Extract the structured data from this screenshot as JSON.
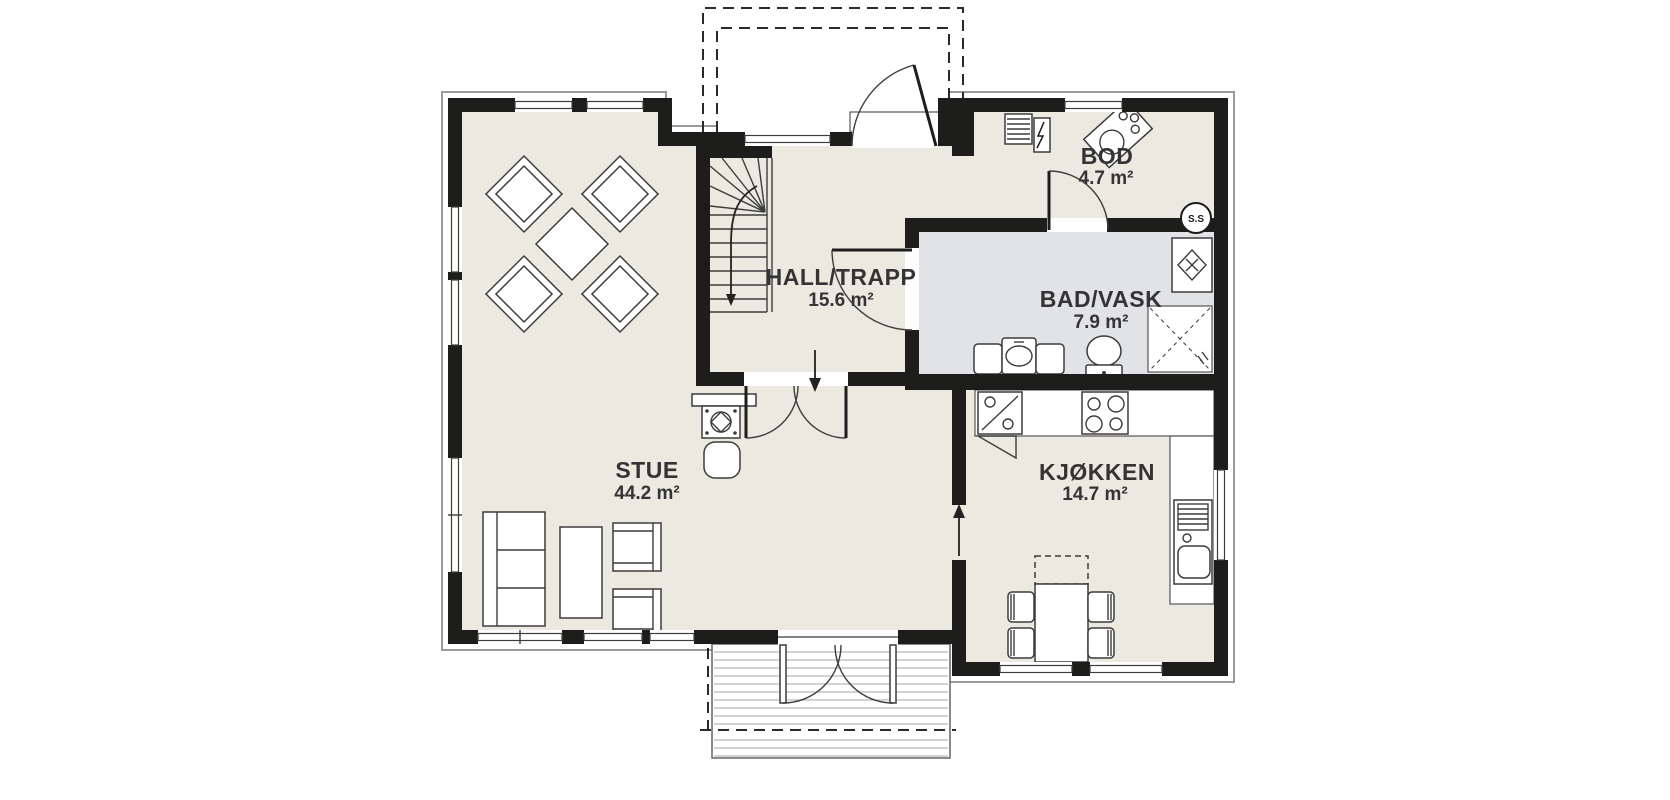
{
  "plan": {
    "rooms": [
      {
        "name": "STUE",
        "area": "44.2 m²"
      },
      {
        "name": "HALL/TRAPP",
        "area": "15.6 m²"
      },
      {
        "name": "BOD",
        "area": "4.7 m²"
      },
      {
        "name": "BAD/VASK",
        "area": "7.9 m²"
      },
      {
        "name": "KJØKKEN",
        "area": "14.7 m²"
      }
    ],
    "fixtures": {
      "water_heater_label": "S.S"
    },
    "colors": {
      "background": "#ffffff",
      "wall": "#1d1d1b",
      "floor": "#ebe9e0",
      "bath_floor": "#e2e3e6",
      "outline": "#9a9a98"
    }
  }
}
